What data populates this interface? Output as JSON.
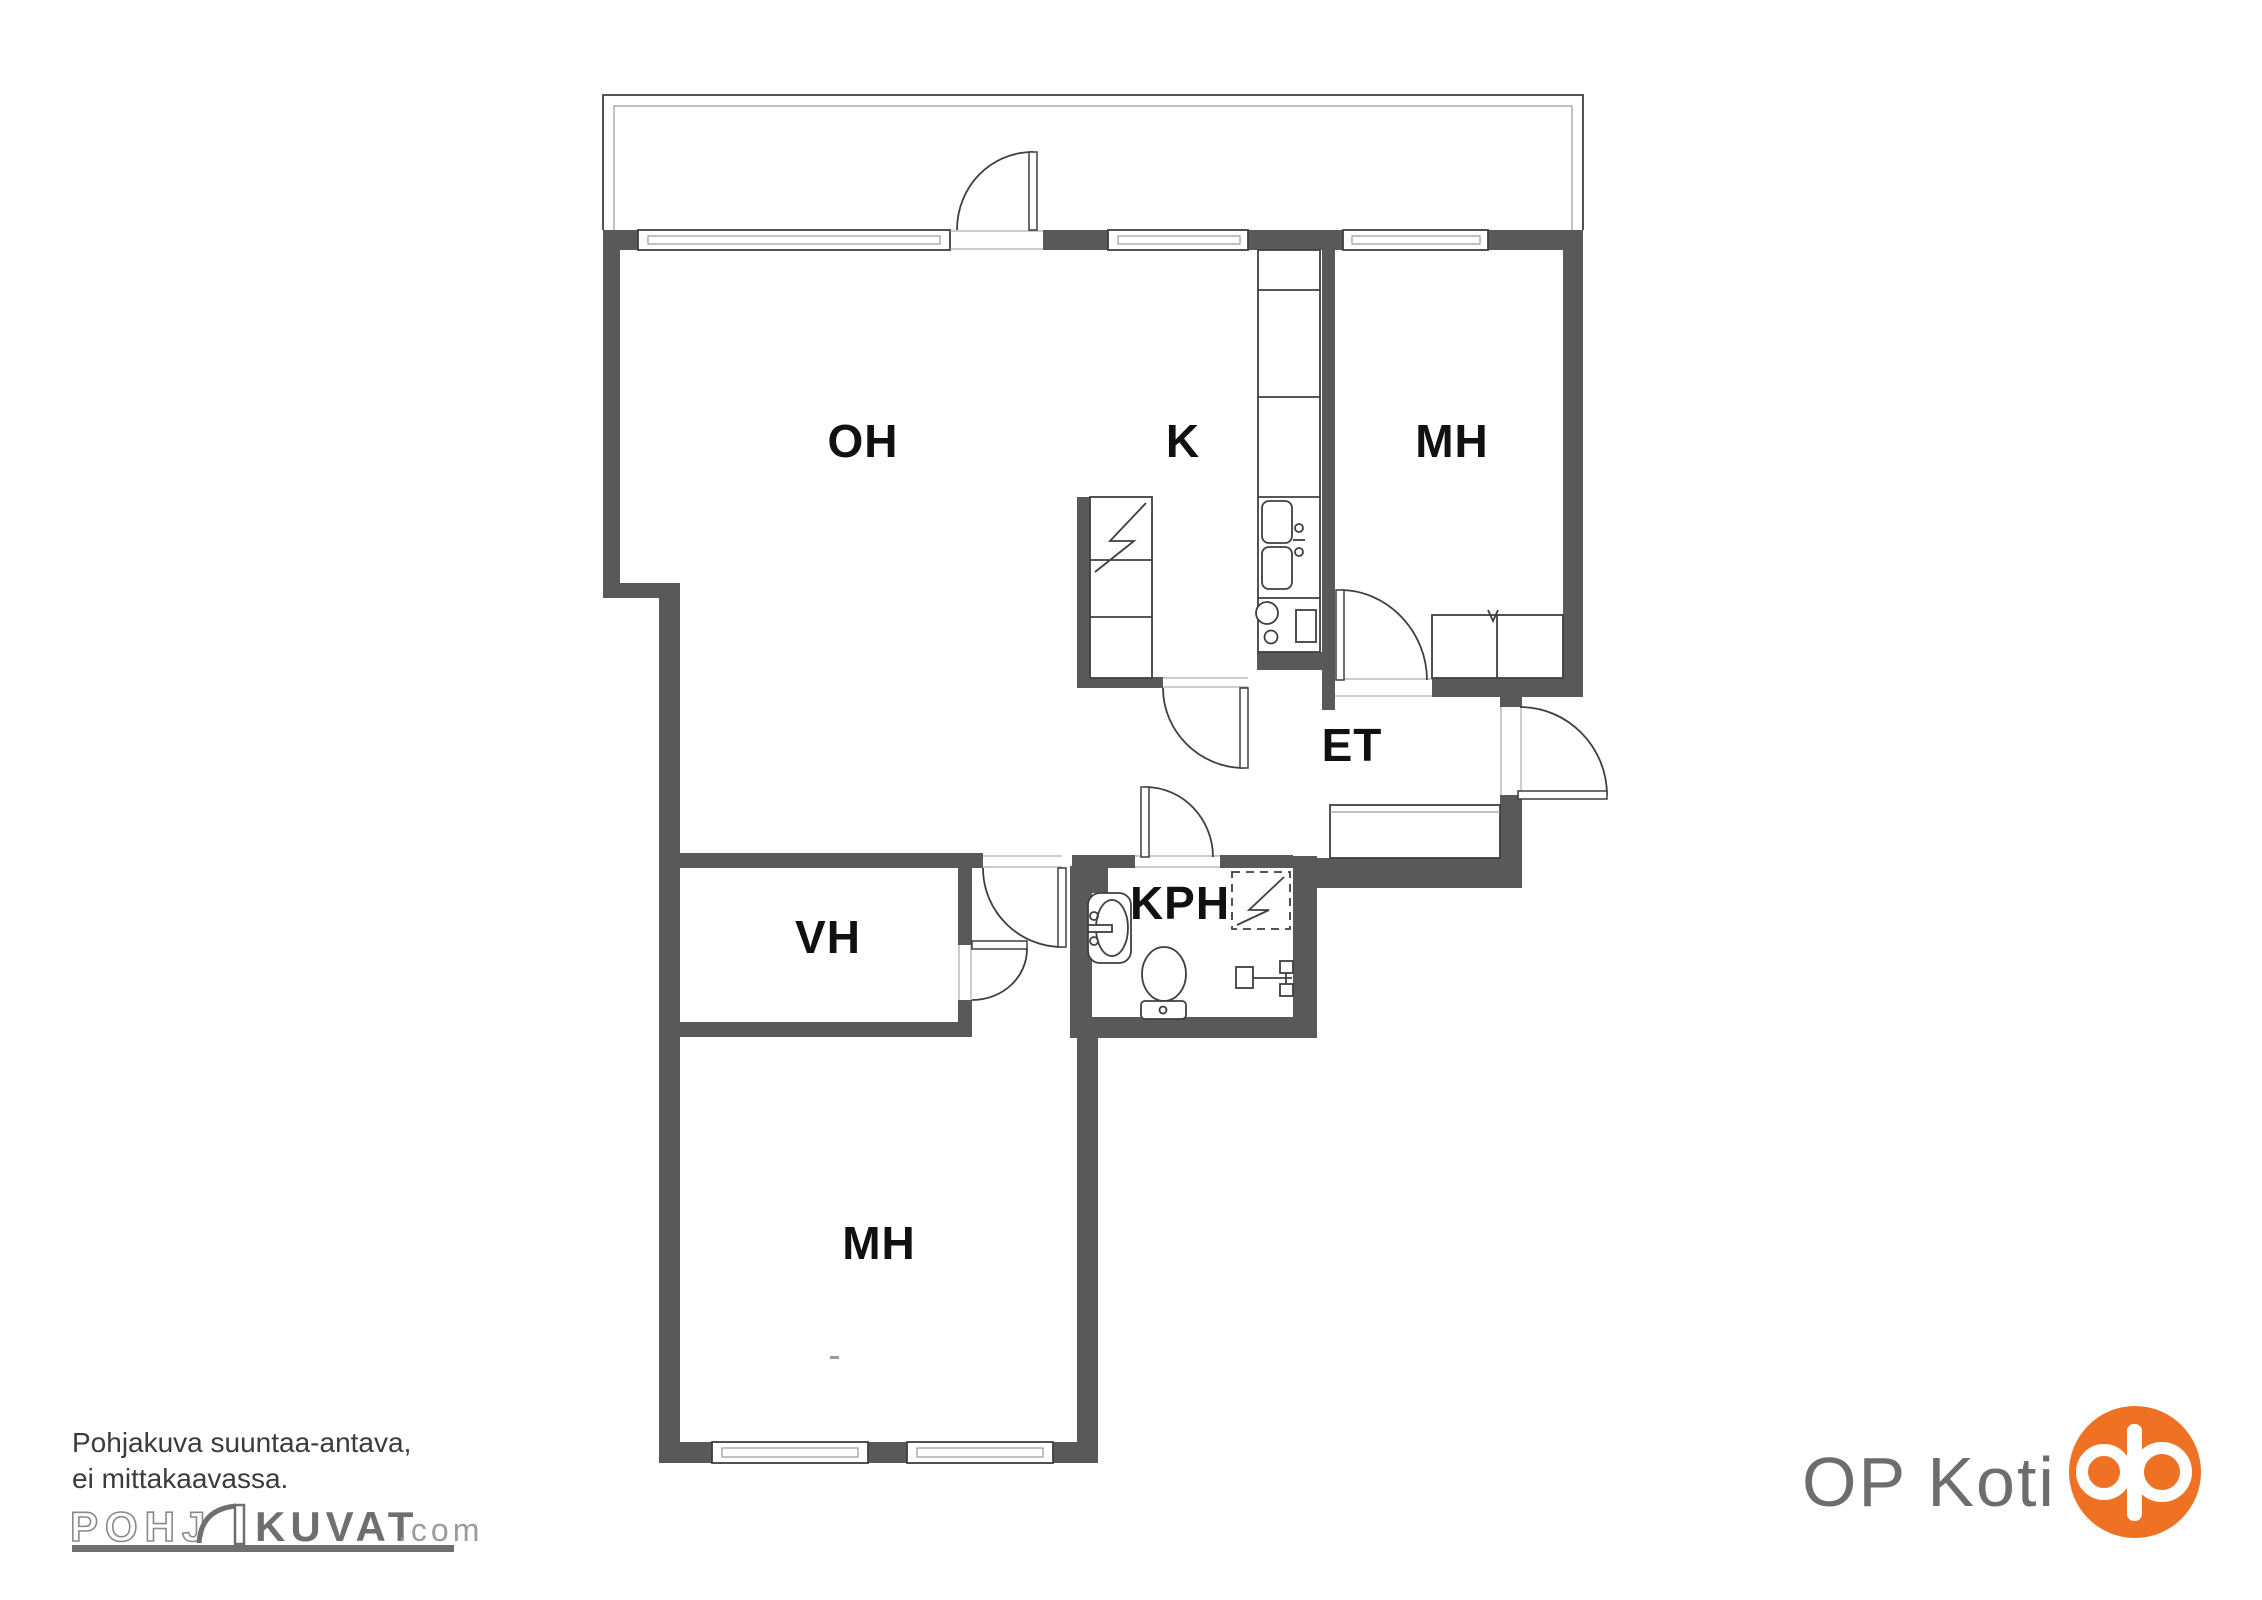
{
  "floorplan": {
    "rooms": [
      {
        "id": "oh",
        "label": "OH"
      },
      {
        "id": "k",
        "label": "K"
      },
      {
        "id": "mh_top",
        "label": "MH"
      },
      {
        "id": "et",
        "label": "ET"
      },
      {
        "id": "kph",
        "label": "KPH"
      },
      {
        "id": "vh",
        "label": "VH"
      },
      {
        "id": "mh_bottom",
        "label": "MH"
      }
    ]
  },
  "footer": {
    "disclaimer_line1": "Pohjakuva suuntaa-antava,",
    "disclaimer_line2": "ei mittakaavassa.",
    "logo": {
      "outline_text": "POHJ",
      "solid_text": "KUVAT",
      "suffix_text": ".com"
    }
  },
  "brand": {
    "name": "OP Koti"
  },
  "colors": {
    "wall": "#595959",
    "line": "#3f3f3f",
    "thin": "#9a9a9a",
    "label": "#111111",
    "footer_text": "#3b3b3b",
    "logo_gray": "#6f6f6f",
    "logo_light": "#9b9b9b",
    "op_text": "#6d6d6d",
    "op_orange": "#ee7124"
  }
}
